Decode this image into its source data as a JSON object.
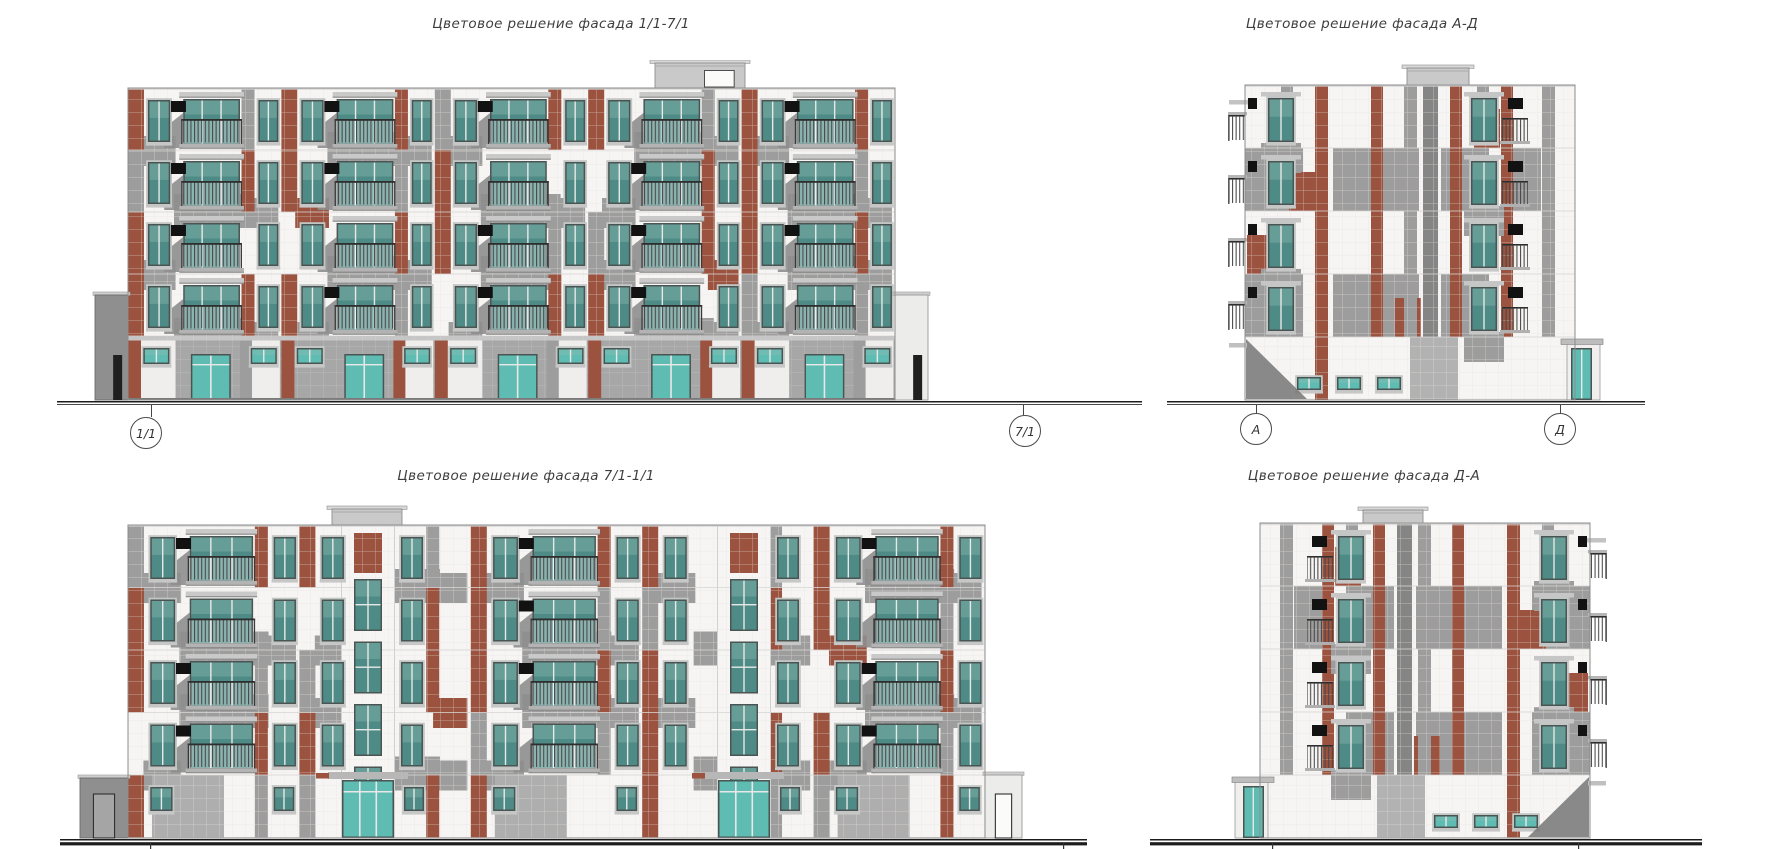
{
  "sheet": {
    "width": 1779,
    "height": 849,
    "background": "#ffffff"
  },
  "drawings": [
    {
      "id": "facade-1-1-7-1",
      "title": "Цветовое решение фасада 1/1-7/1",
      "axis_left": "1/1",
      "axis_right": "7/1"
    },
    {
      "id": "facade-a-d",
      "title": "Цветовое решение фасада А-Д",
      "axis_left": "А",
      "axis_right": "Д"
    },
    {
      "id": "facade-7-1-1-1",
      "title": "Цветовое решение фасада 7/1-1/1"
    },
    {
      "id": "facade-d-a",
      "title": "Цветовое решение фасада Д-А"
    }
  ],
  "colors": {
    "paper": "#ffffff",
    "panel_white": "#f6f5f3",
    "panel_grid": "#e7e5e1",
    "panel_gray": "#9d9d9d",
    "panel_gray_dark": "#858585",
    "panel_gray_light": "#c7c7c7",
    "terracotta": "#9b523e",
    "terracotta_dark": "#7c4434",
    "glass_teal": "#4e8a86",
    "glass_teal_light": "#8fbcb4",
    "storefront_teal": "#5fbcb2",
    "window_frame": "#4a5553",
    "railing": "#474747",
    "shadow": "#8e8e8e",
    "shadow_dark": "#6e6e6e",
    "ac_unit": "#121212",
    "ground_line": "#1c1c1c",
    "outline": "#8c8c8c",
    "text": "#3e3e3e"
  }
}
